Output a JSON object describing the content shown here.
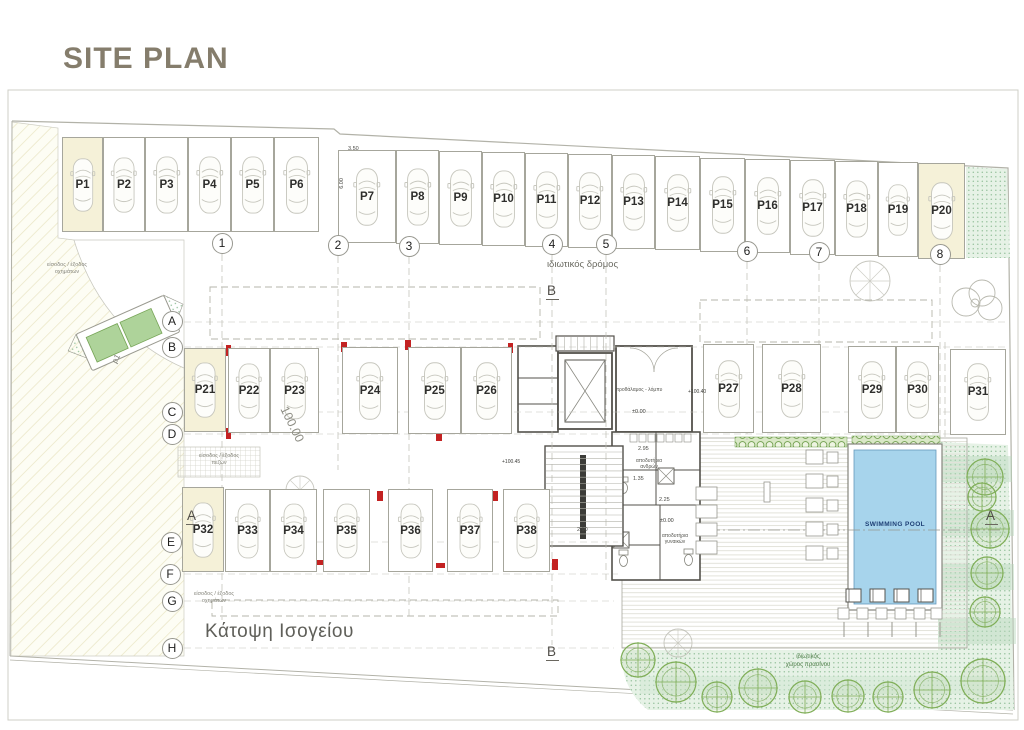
{
  "title": "SITE PLAN",
  "colors": {
    "highlight": "#f5f1d8",
    "pool_water": "#a7d4ec",
    "pool_text": "#1e3f75",
    "column_red": "#c32222",
    "tree_green": "#7fae57",
    "title": "#857d6c"
  },
  "parking": {
    "stalls": [
      {
        "label": "P1",
        "x": 62,
        "y": 137,
        "w": 41,
        "h": 95,
        "hl": true
      },
      {
        "label": "P2",
        "x": 103,
        "y": 137,
        "w": 42,
        "h": 95
      },
      {
        "label": "P3",
        "x": 145,
        "y": 137,
        "w": 43,
        "h": 95
      },
      {
        "label": "P4",
        "x": 188,
        "y": 137,
        "w": 43,
        "h": 95
      },
      {
        "label": "P5",
        "x": 231,
        "y": 137,
        "w": 43,
        "h": 95
      },
      {
        "label": "P6",
        "x": 274,
        "y": 137,
        "w": 45,
        "h": 95
      },
      {
        "label": "P7",
        "x": 338,
        "y": 150,
        "w": 58,
        "h": 93
      },
      {
        "label": "P8",
        "x": 396,
        "y": 150,
        "w": 43,
        "h": 94
      },
      {
        "label": "P9",
        "x": 439,
        "y": 151,
        "w": 43,
        "h": 94
      },
      {
        "label": "P10",
        "x": 482,
        "y": 152,
        "w": 43,
        "h": 94
      },
      {
        "label": "P11",
        "x": 525,
        "y": 153,
        "w": 43,
        "h": 94
      },
      {
        "label": "P12",
        "x": 568,
        "y": 154,
        "w": 44,
        "h": 94
      },
      {
        "label": "P13",
        "x": 612,
        "y": 155,
        "w": 43,
        "h": 94
      },
      {
        "label": "P14",
        "x": 655,
        "y": 156,
        "w": 45,
        "h": 94
      },
      {
        "label": "P15",
        "x": 700,
        "y": 158,
        "w": 45,
        "h": 94
      },
      {
        "label": "P16",
        "x": 745,
        "y": 159,
        "w": 45,
        "h": 94
      },
      {
        "label": "P17",
        "x": 790,
        "y": 160,
        "w": 45,
        "h": 95
      },
      {
        "label": "P18",
        "x": 835,
        "y": 161,
        "w": 43,
        "h": 95
      },
      {
        "label": "P19",
        "x": 878,
        "y": 162,
        "w": 40,
        "h": 95
      },
      {
        "label": "P20",
        "x": 918,
        "y": 163,
        "w": 47,
        "h": 96,
        "hl": true
      },
      {
        "label": "P21",
        "x": 184,
        "y": 348,
        "w": 42,
        "h": 84,
        "hl": true
      },
      {
        "label": "P22",
        "x": 228,
        "y": 348,
        "w": 42,
        "h": 85
      },
      {
        "label": "P23",
        "x": 270,
        "y": 348,
        "w": 49,
        "h": 85
      },
      {
        "label": "P24",
        "x": 342,
        "y": 347,
        "w": 56,
        "h": 87
      },
      {
        "label": "P25",
        "x": 408,
        "y": 347,
        "w": 53,
        "h": 87
      },
      {
        "label": "P26",
        "x": 461,
        "y": 347,
        "w": 51,
        "h": 87
      },
      {
        "label": "P27",
        "x": 703,
        "y": 344,
        "w": 51,
        "h": 89
      },
      {
        "label": "P28",
        "x": 762,
        "y": 344,
        "w": 59,
        "h": 89
      },
      {
        "label": "P29",
        "x": 848,
        "y": 346,
        "w": 48,
        "h": 87
      },
      {
        "label": "P30",
        "x": 896,
        "y": 346,
        "w": 43,
        "h": 87
      },
      {
        "label": "P31",
        "x": 950,
        "y": 349,
        "w": 56,
        "h": 86
      },
      {
        "label": "P32",
        "x": 182,
        "y": 487,
        "w": 42,
        "h": 85,
        "hl": true
      },
      {
        "label": "P33",
        "x": 225,
        "y": 489,
        "w": 45,
        "h": 83
      },
      {
        "label": "P34",
        "x": 270,
        "y": 489,
        "w": 47,
        "h": 83
      },
      {
        "label": "P35",
        "x": 323,
        "y": 489,
        "w": 47,
        "h": 83
      },
      {
        "label": "P36",
        "x": 388,
        "y": 489,
        "w": 45,
        "h": 83
      },
      {
        "label": "P37",
        "x": 447,
        "y": 489,
        "w": 46,
        "h": 83
      },
      {
        "label": "P38",
        "x": 503,
        "y": 489,
        "w": 47,
        "h": 83
      }
    ]
  },
  "grid": {
    "numbers": [
      {
        "label": "1",
        "x": 222,
        "y": 243
      },
      {
        "label": "2",
        "x": 338,
        "y": 245
      },
      {
        "label": "3",
        "x": 409,
        "y": 246
      },
      {
        "label": "4",
        "x": 552,
        "y": 244
      },
      {
        "label": "5",
        "x": 606,
        "y": 244
      },
      {
        "label": "6",
        "x": 747,
        "y": 251
      },
      {
        "label": "7",
        "x": 819,
        "y": 252
      },
      {
        "label": "8",
        "x": 940,
        "y": 254
      }
    ],
    "letters": [
      {
        "label": "A",
        "x": 172,
        "y": 321
      },
      {
        "label": "B",
        "x": 172,
        "y": 347
      },
      {
        "label": "C",
        "x": 172,
        "y": 412
      },
      {
        "label": "D",
        "x": 172,
        "y": 434
      },
      {
        "label": "E",
        "x": 171,
        "y": 542
      },
      {
        "label": "F",
        "x": 170,
        "y": 574
      },
      {
        "label": "G",
        "x": 172,
        "y": 601
      },
      {
        "label": "H",
        "x": 172,
        "y": 648
      }
    ]
  },
  "labels": {
    "road": "ιδιωτικός δρόμος",
    "plan": "Κάτοψη Ισογείου",
    "pool": "SWIMMING POOL",
    "green_line1": "ιδιωτικός",
    "green_line2": "χώρος πρασίνου",
    "entrance_line1": "είσοδος / έξοδος",
    "vehicles": "οχημάτων",
    "pedestrians": "πεζών",
    "lobby": "προθάλαμος - λόμπυ",
    "changing_line1": "αποδυτήρια",
    "men": "ανδρών",
    "women": "γυναικών",
    "ramp": "ρ1"
  },
  "dimensions": {
    "p7_width": "3.50",
    "p7_depth": "6.00",
    "stair": "2.90",
    "room_w": "2.95",
    "room_a": "1.35",
    "room_b": "2.25",
    "level_zero": "±0.00",
    "level_plus40": "+100.40",
    "level_plus45": "+100.45",
    "site_level": "100.00"
  },
  "markers": {
    "a": "A",
    "b": "B"
  }
}
